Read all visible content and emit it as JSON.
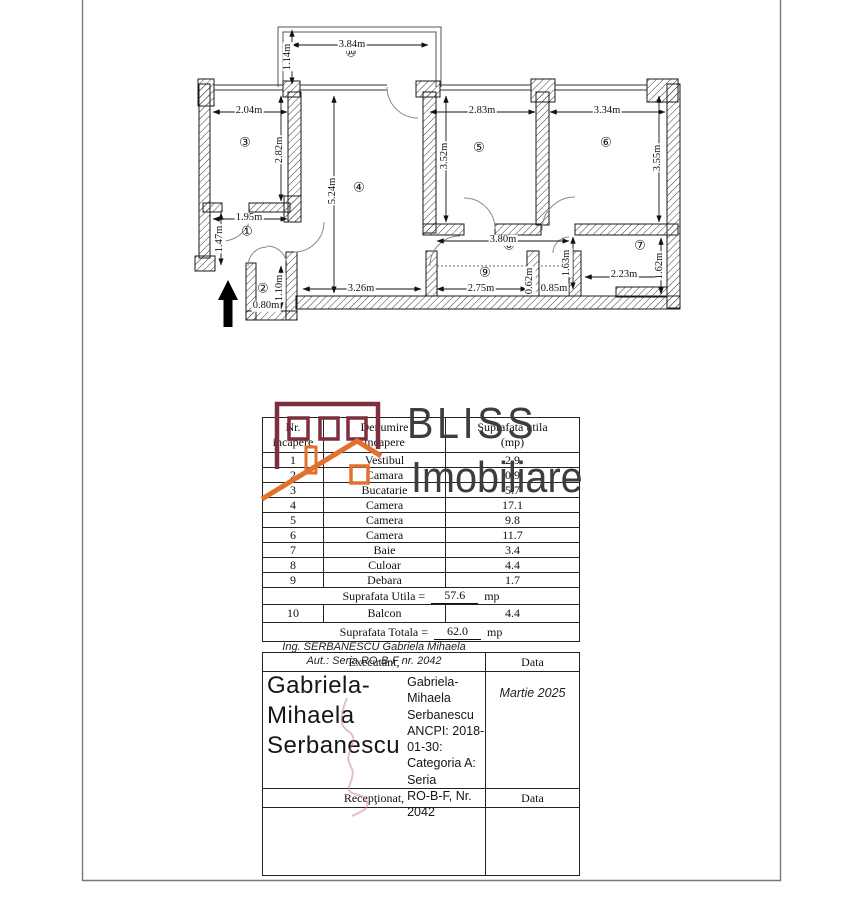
{
  "plan": {
    "rooms": [
      "①",
      "②",
      "③",
      "④",
      "⑤",
      "⑥",
      "⑦",
      "⑧",
      "⑨",
      "⑩"
    ],
    "dims": {
      "balcony_w": "3.84m",
      "balcony_d": "1.14m",
      "r3_w": "2.04m",
      "r3_h": "2.82m",
      "r4_h": "5.24m",
      "r4_w": "3.26m",
      "r5_w": "2.83m",
      "r5_h": "3.52m",
      "r6_w": "3.34m",
      "r6_h": "3.55m",
      "r1_w": "1.95m",
      "r1_h": "1.47m",
      "r2_h": "1.10m",
      "r2_w": "0.80m",
      "r8_w": "3.80m",
      "r9_w": "2.75m",
      "r9_h": "0.62m",
      "r9b_w": "0.85m",
      "r7_door": "1.63m",
      "r7_w": "2.23m",
      "r7_h": "1.62m"
    }
  },
  "logo": {
    "word1": "BLISS",
    "word2": "Imobiliare",
    "maroon": "#7d2f3e",
    "orange": "#e2712e",
    "text_color": "#3d3d3d"
  },
  "table": {
    "header": {
      "col1a": "Nr.",
      "col1b": "incapere",
      "col2a": "Denumire",
      "col2b": "incapere",
      "col3a": "Suprafata utila",
      "col3b": "(mp)"
    },
    "rows": [
      {
        "nr": "1",
        "name": "Vestibul",
        "area": "2.9"
      },
      {
        "nr": "2",
        "name": "Camara",
        "area": "0.9"
      },
      {
        "nr": "3",
        "name": "Bucatarie",
        "area": "5.7"
      },
      {
        "nr": "4",
        "name": "Camera",
        "area": "17.1"
      },
      {
        "nr": "5",
        "name": "Camera",
        "area": "9.8"
      },
      {
        "nr": "6",
        "name": "Camera",
        "area": "11.7"
      },
      {
        "nr": "7",
        "name": "Baie",
        "area": "3.4"
      },
      {
        "nr": "8",
        "name": "Culoar",
        "area": "4.4"
      },
      {
        "nr": "9",
        "name": "Debara",
        "area": "1.7"
      }
    ],
    "utila_label": "Suprafata Utila =",
    "utila_value": "57.6",
    "utila_unit": "mp",
    "balcony_row": {
      "nr": "10",
      "name": "Balcon",
      "area": "4.4"
    },
    "totala_label": "Suprafata Totala =",
    "totala_value": "62.0",
    "totala_unit": "mp"
  },
  "signature": {
    "executant": "Executant,",
    "data_label": "Data",
    "line1": "Ing. SERBANESCU Gabriela Mihaela",
    "line2": "Aut.: Seria RO-B-F nr. 2042",
    "date": "Martie 2025",
    "big_name_l1": "Gabriela-",
    "big_name_l2": "Mihaela",
    "big_name_l3": "Serbanescu",
    "cert_l1": "Gabriela-Mihaela",
    "cert_l2": "Serbanescu",
    "cert_l3": "ANCPI: 2018-01-30:",
    "cert_l4": "Categoria A: Seria",
    "cert_l5": "RO-B-F, Nr. 2042",
    "receptionat": "Recepţionat,",
    "data_label2": "Data"
  }
}
